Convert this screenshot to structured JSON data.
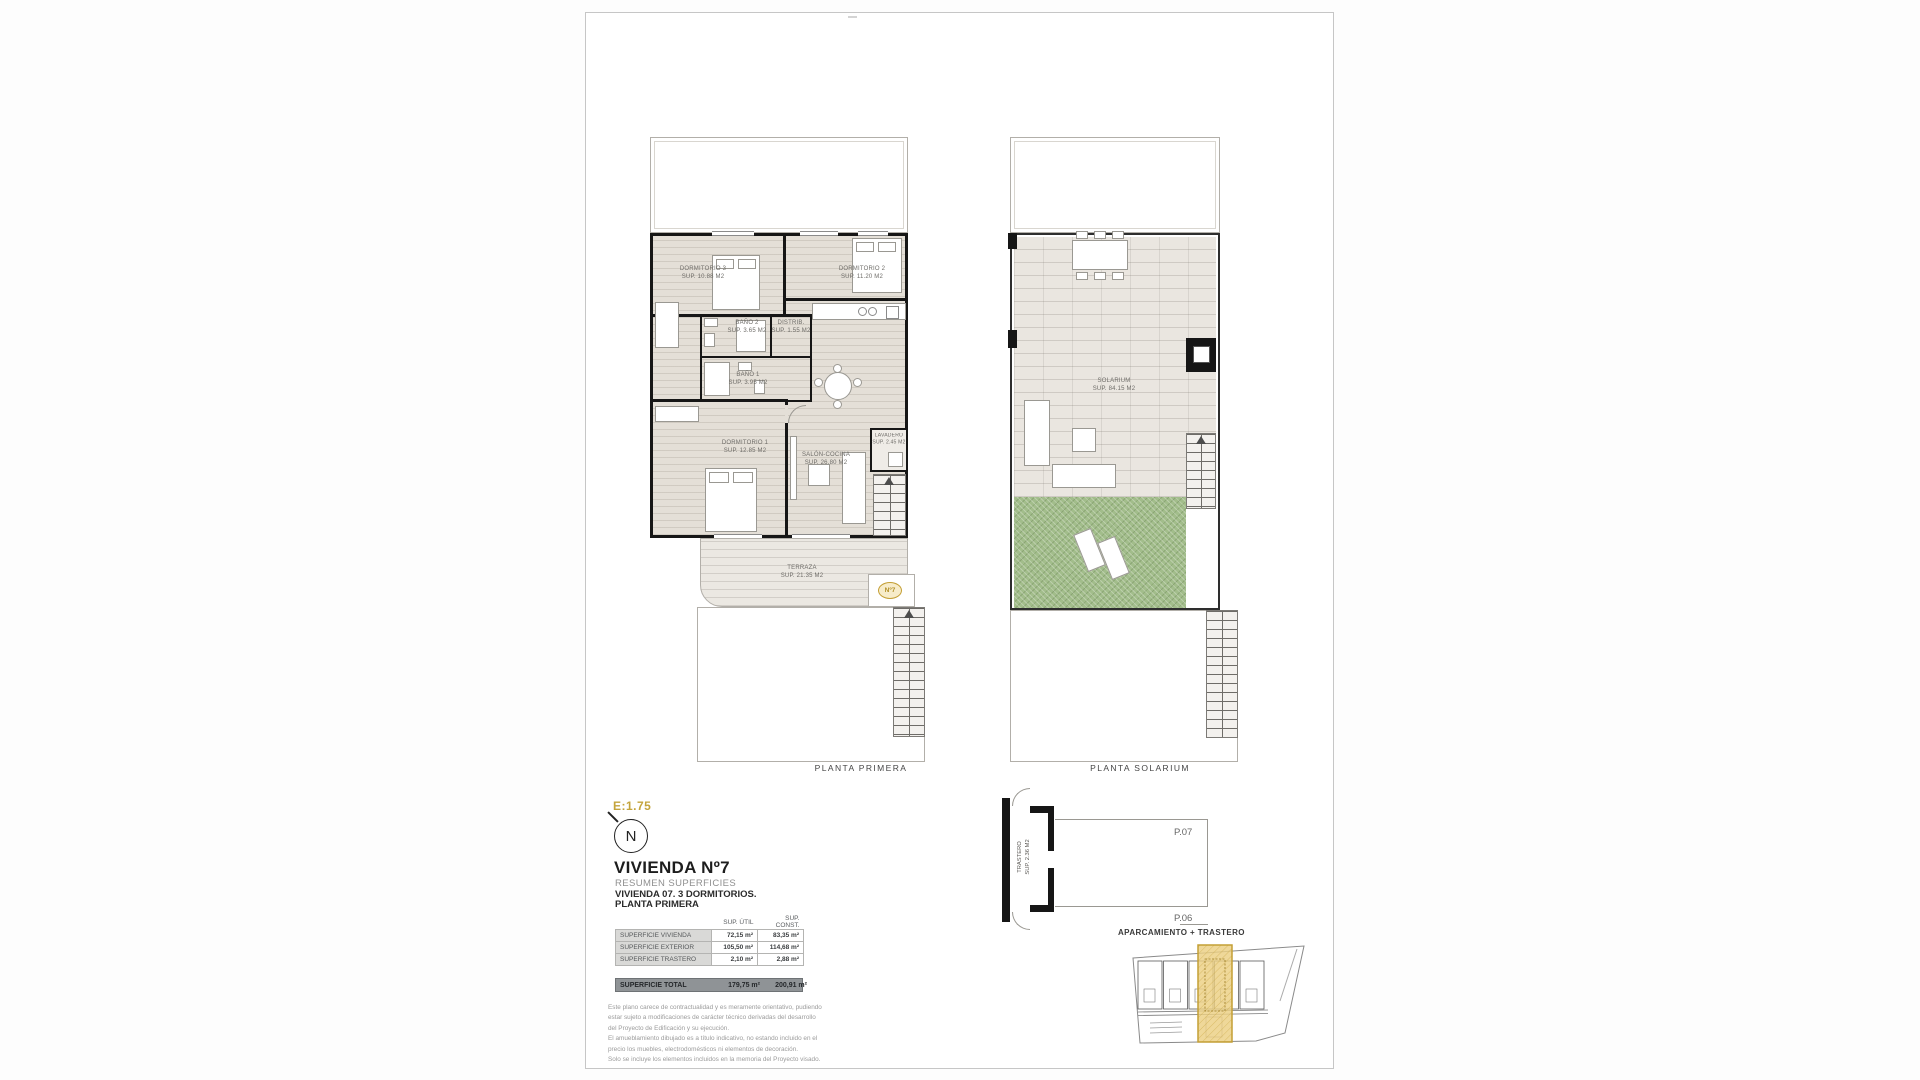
{
  "page": {
    "scale_label": "E:1.75",
    "north_letter": "N"
  },
  "plans": {
    "primera": {
      "caption": "PLANTA PRIMERA",
      "unit_badge": "Nº7",
      "rooms": {
        "dorm3": {
          "name": "DORMITORIO 3",
          "area": "SUP. 10.88 M2"
        },
        "dorm2": {
          "name": "DORMITORIO 2",
          "area": "SUP. 11.20 M2"
        },
        "dorm1": {
          "name": "DORMITORIO 1",
          "area": "SUP. 12.85 M2"
        },
        "bano2": {
          "name": "BAÑO 2",
          "area": "SUP. 3.65 M2"
        },
        "bano1": {
          "name": "BAÑO 1",
          "area": "SUP. 3.95 M2"
        },
        "distrib": {
          "name": "DISTRIB.",
          "area": "SUP. 1.55 M2"
        },
        "salon": {
          "name": "SALÓN-COCINA",
          "area": "SUP. 26.80 M2"
        },
        "lavadero": {
          "name": "LAVADERO",
          "area": "SUP. 2.45 M2"
        },
        "terraza": {
          "name": "TERRAZA",
          "area": "SUP. 21.35 M2"
        }
      }
    },
    "solarium": {
      "caption": "PLANTA SOLARIUM",
      "rooms": {
        "solarium": {
          "name": "SOLARIUM",
          "area": "SUP. 84.15 M2"
        }
      }
    }
  },
  "title_block": {
    "title": "VIVIENDA Nº7",
    "subtitle": "RESUMEN SUPERFICIES",
    "line2": "VIVIENDA 07. 3 DORMITORIOS.",
    "line3": "PLANTA PRIMERA",
    "table": {
      "col_util": "SUP. ÚTIL",
      "col_const": "SUP. CONST.",
      "rows": [
        {
          "label": "SUPERFICIE VIVIENDA",
          "util": "72,15 m²",
          "const": "83,35 m²"
        },
        {
          "label": "SUPERFICIE EXTERIOR",
          "util": "105,50 m²",
          "const": "114,68 m²"
        },
        {
          "label": "SUPERFICIE TRASTERO",
          "util": "2,10 m²",
          "const": "2,88 m²"
        }
      ],
      "total": {
        "label": "SUPERFICIE TOTAL",
        "util": "179,75 m²",
        "const": "200,91 m²"
      }
    },
    "disclaimer": [
      "Este plano carece de contractualidad y es meramente orientativo, pudiendo",
      "estar sujeto a modificaciones de carácter técnico derivadas del desarrollo",
      "del Proyecto de Edificación y su ejecución.",
      "El amueblamiento dibujado es a título indicativo, no estando incluido en el",
      "precio los muebles, electrodomésticos ni elementos de decoración.",
      "Solo se incluye los elementos incluidos en la memoria del Proyecto visado."
    ]
  },
  "storage": {
    "trastero_name": "TRASTERO",
    "trastero_area": "SUP. 2.36 M2",
    "p07": "P.07",
    "p06": "P.06",
    "caption": "APARCAMIENTO + TRASTERO"
  },
  "colors": {
    "accent_gold": "#c4a43c",
    "highlight_fill": "#eccf82",
    "grass_green": "#a2bd8b",
    "wall_black": "#161616"
  }
}
